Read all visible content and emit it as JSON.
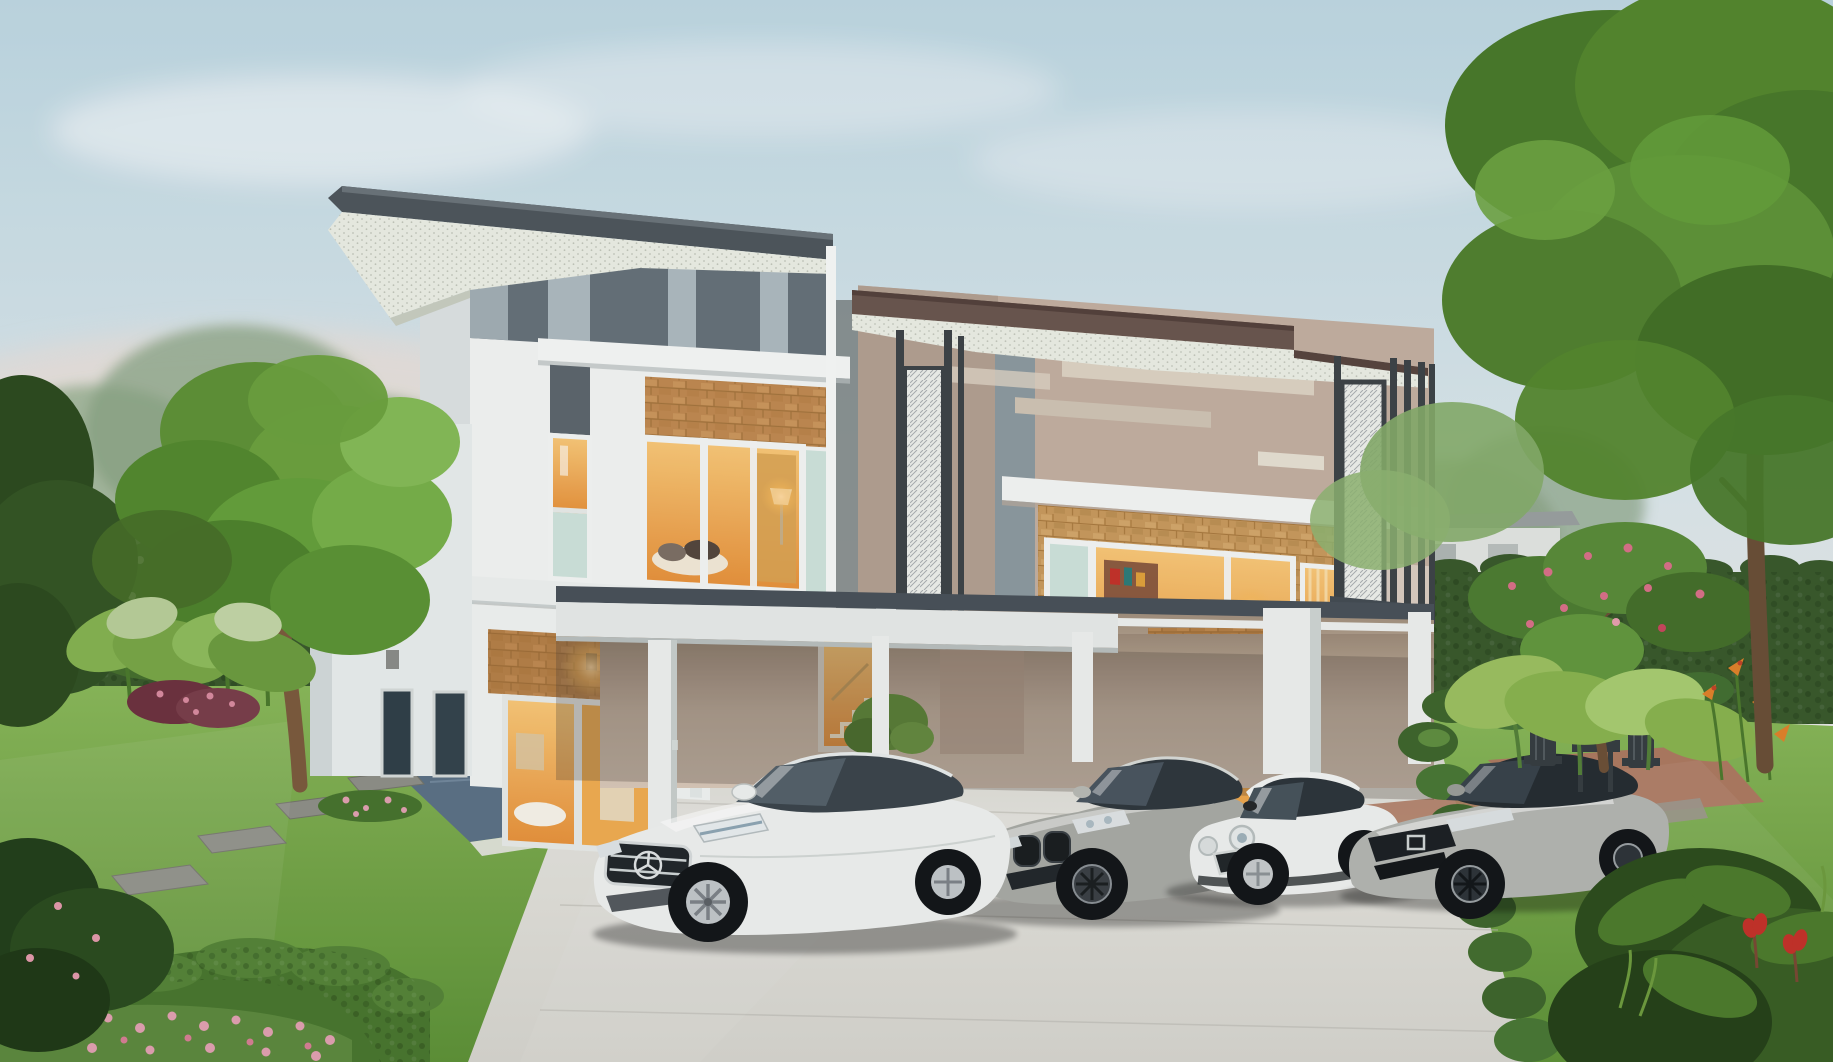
{
  "scene": {
    "title": "Twin modern two-storey houses at dusk",
    "description": "Architectural rendering of two modern detached two-storey houses with warm interior lights on, shared landscaped front garden, concrete driveway and four parked cars",
    "left_house": {
      "style": "white and grey skillion-roof house",
      "features": [
        "dark grey roof band",
        "perforated white soffit",
        "grey frieze with light stripes",
        "brick accent panels",
        "lit upstairs bay window",
        "slim vertical window",
        "ground-floor sliding glass doors",
        "warm wall lamp",
        "blue-grey tiled porch"
      ]
    },
    "right_house": {
      "style": "beige and brown flat-roof house",
      "features": [
        "brown roof fascia",
        "perforated white soffit",
        "beige walls with light stripes",
        "brick bay window upstairs",
        "balcony with dark vertical slats and white perforated screen",
        "ground-floor brick accent with wall lamp",
        "glass doors with red fire-extinguisher cabinet"
      ]
    },
    "carport": {
      "features": [
        "white flat canopy",
        "white columns",
        "lit stair window",
        "planter shrub"
      ]
    },
    "cars": [
      {
        "name": "white luxury sedan",
        "badge": "three-pointed star grille emblem",
        "color": "#eff1f0"
      },
      {
        "name": "grey sports coupe",
        "badge": "twin-kidney grille",
        "color": "#a9aba6"
      },
      {
        "name": "white compact hatchback",
        "badge": "round headlamps, white roof",
        "color": "#f0f1ef"
      },
      {
        "name": "silver compact sedan",
        "badge": "H grille emblem",
        "color": "#b4b6b2"
      }
    ],
    "garden": [
      "green lawns",
      "clipped hedge walls",
      "box hedges",
      "plumeria trees with white and pink blossoms",
      "elephant-ear plants",
      "pink flower bed",
      "red canna flowers",
      "orange heliconia",
      "grey stepping stones",
      "terracotta pavers",
      "dark outdoor table and chairs"
    ],
    "sky": "soft pale blue fading to warm pink near the horizon"
  },
  "palette": {
    "sky_top": "#bfd8e4",
    "sky_mid": "#dbe8ec",
    "sky_low": "#efe9e5",
    "sky_blush": "#f5ded2",
    "cloud": "#ffffff",
    "foliage_dark": "#2e4c20",
    "foliage": "#4c7c2c",
    "foliage_mid": "#5f9438",
    "foliage_light": "#7fb251",
    "foliage_haze": "#9bb294",
    "hedge": "#3a5a2d",
    "lawn_light": "#8ab85a",
    "lawn_dark": "#5e9238",
    "trunk": "#7c5b3e",
    "roof_gray": "#4f575d",
    "soffit": "#ecefe6",
    "frieze": "#67727a",
    "frieze_stripe": "#aebac0",
    "wall_white": "#f3f5f4",
    "wall_shade": "#dde3e4",
    "roof_brown": "#6b5750",
    "wall_beige": "#c4b0a2",
    "wall_beige_dark": "#b3a092",
    "stripe_beige": "#ddd3c4",
    "brick": "#c08a52",
    "brick_dark": "#a5753e",
    "brick_light": "#d4a266",
    "glow": "#f6b95c",
    "glow_deep": "#e8933d",
    "glass_teal": "#cfe4dc",
    "glass_dark": "#31414a",
    "canopy_top": "#4a525a",
    "canopy_face": "#e8ebea",
    "column": "#eef0ef",
    "screen_white": "#eef0ec",
    "screen_dark": "#3e4549",
    "drive_far": "#cfcfc8",
    "drive_mid": "#e4e3dd",
    "drive_near": "#d6d5cf",
    "paver_terra": "#ad7a62",
    "paver_gray": "#9a948a",
    "stone": "#8f9089",
    "porch_tile": "#5c7287",
    "car_white": "#eff1f0",
    "car_gray": "#a9aba6",
    "car_silver": "#b4b6b2",
    "car_glass": "#323a41",
    "tire": "#14171a",
    "flower_pink": "#e2a2b2",
    "flower_red": "#c5332b",
    "flower_white": "#edf1e0",
    "heliconia": "#e0832c",
    "burgundy": "#7a3f4c",
    "shadow_warm": "#4a4138",
    "patio_furniture": "#373e43",
    "distant_house": "#e3e6e3"
  }
}
